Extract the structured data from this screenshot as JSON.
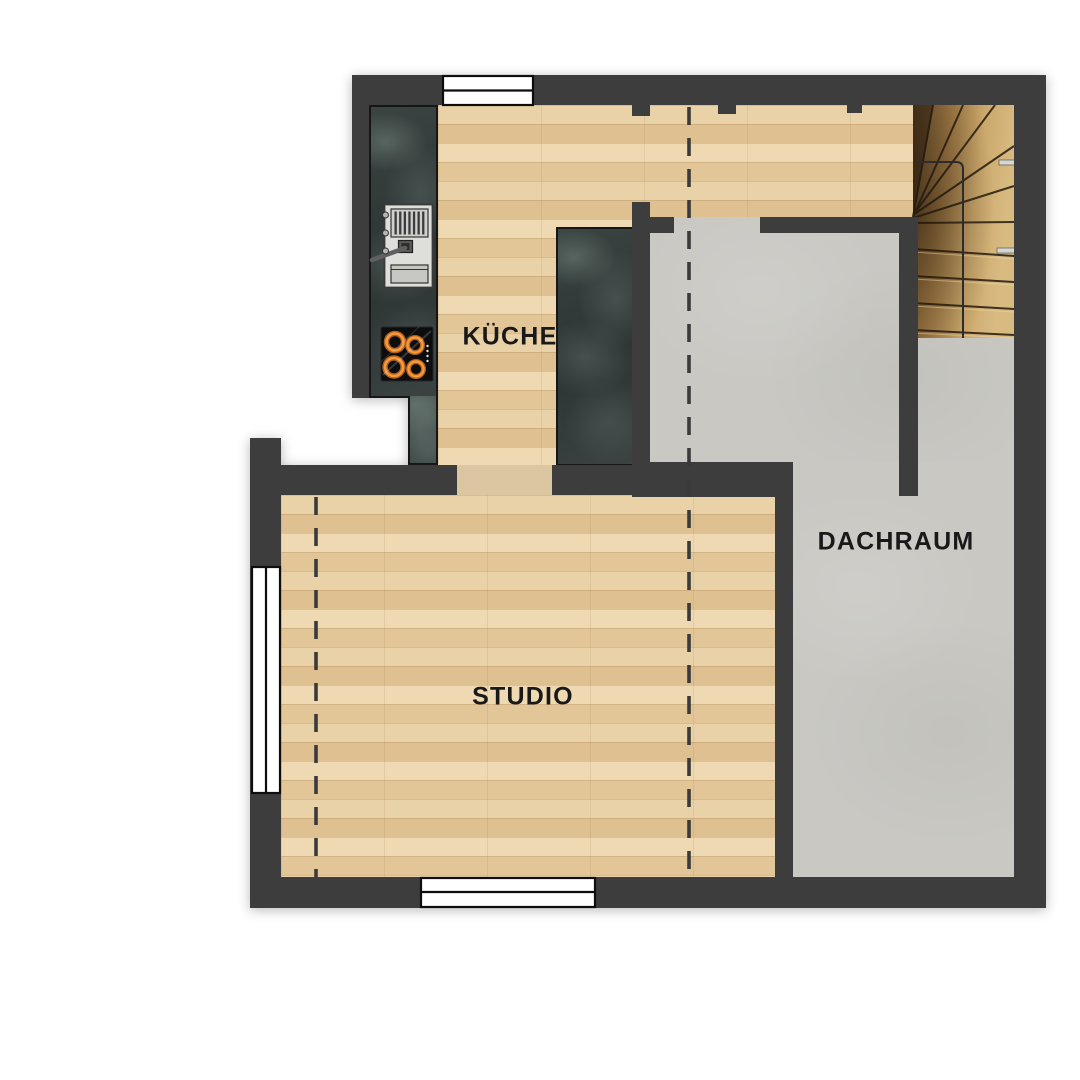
{
  "plan": {
    "type": "attic-floor-plan",
    "rooms": {
      "kueche": {
        "label": "KÜCHE"
      },
      "studio": {
        "label": "STUDIO"
      },
      "dachraum": {
        "label": "DACHRAUM"
      }
    },
    "features": {
      "staircase": "winder-staircase",
      "cooktop": "4-burner-cooktop",
      "sink_unit": "kitchen-sink-unit",
      "wardrobe": "built-in-dark-cabinet",
      "windows": [
        "top-window",
        "left-window",
        "bottom-window"
      ],
      "dashed_lines": "ceiling-height-lines"
    },
    "colors": {
      "wall": "#3d3d3d",
      "wood_floor": "#e5cb9f",
      "stair_wood": "#b98f52",
      "gray_floor": "#c9c8c3",
      "counter_slate": "#333d3b",
      "threshold": "#dcc6a1",
      "burner_orange": "#f79b3a",
      "window_white": "#ffffff",
      "label_text": "#191919"
    }
  }
}
